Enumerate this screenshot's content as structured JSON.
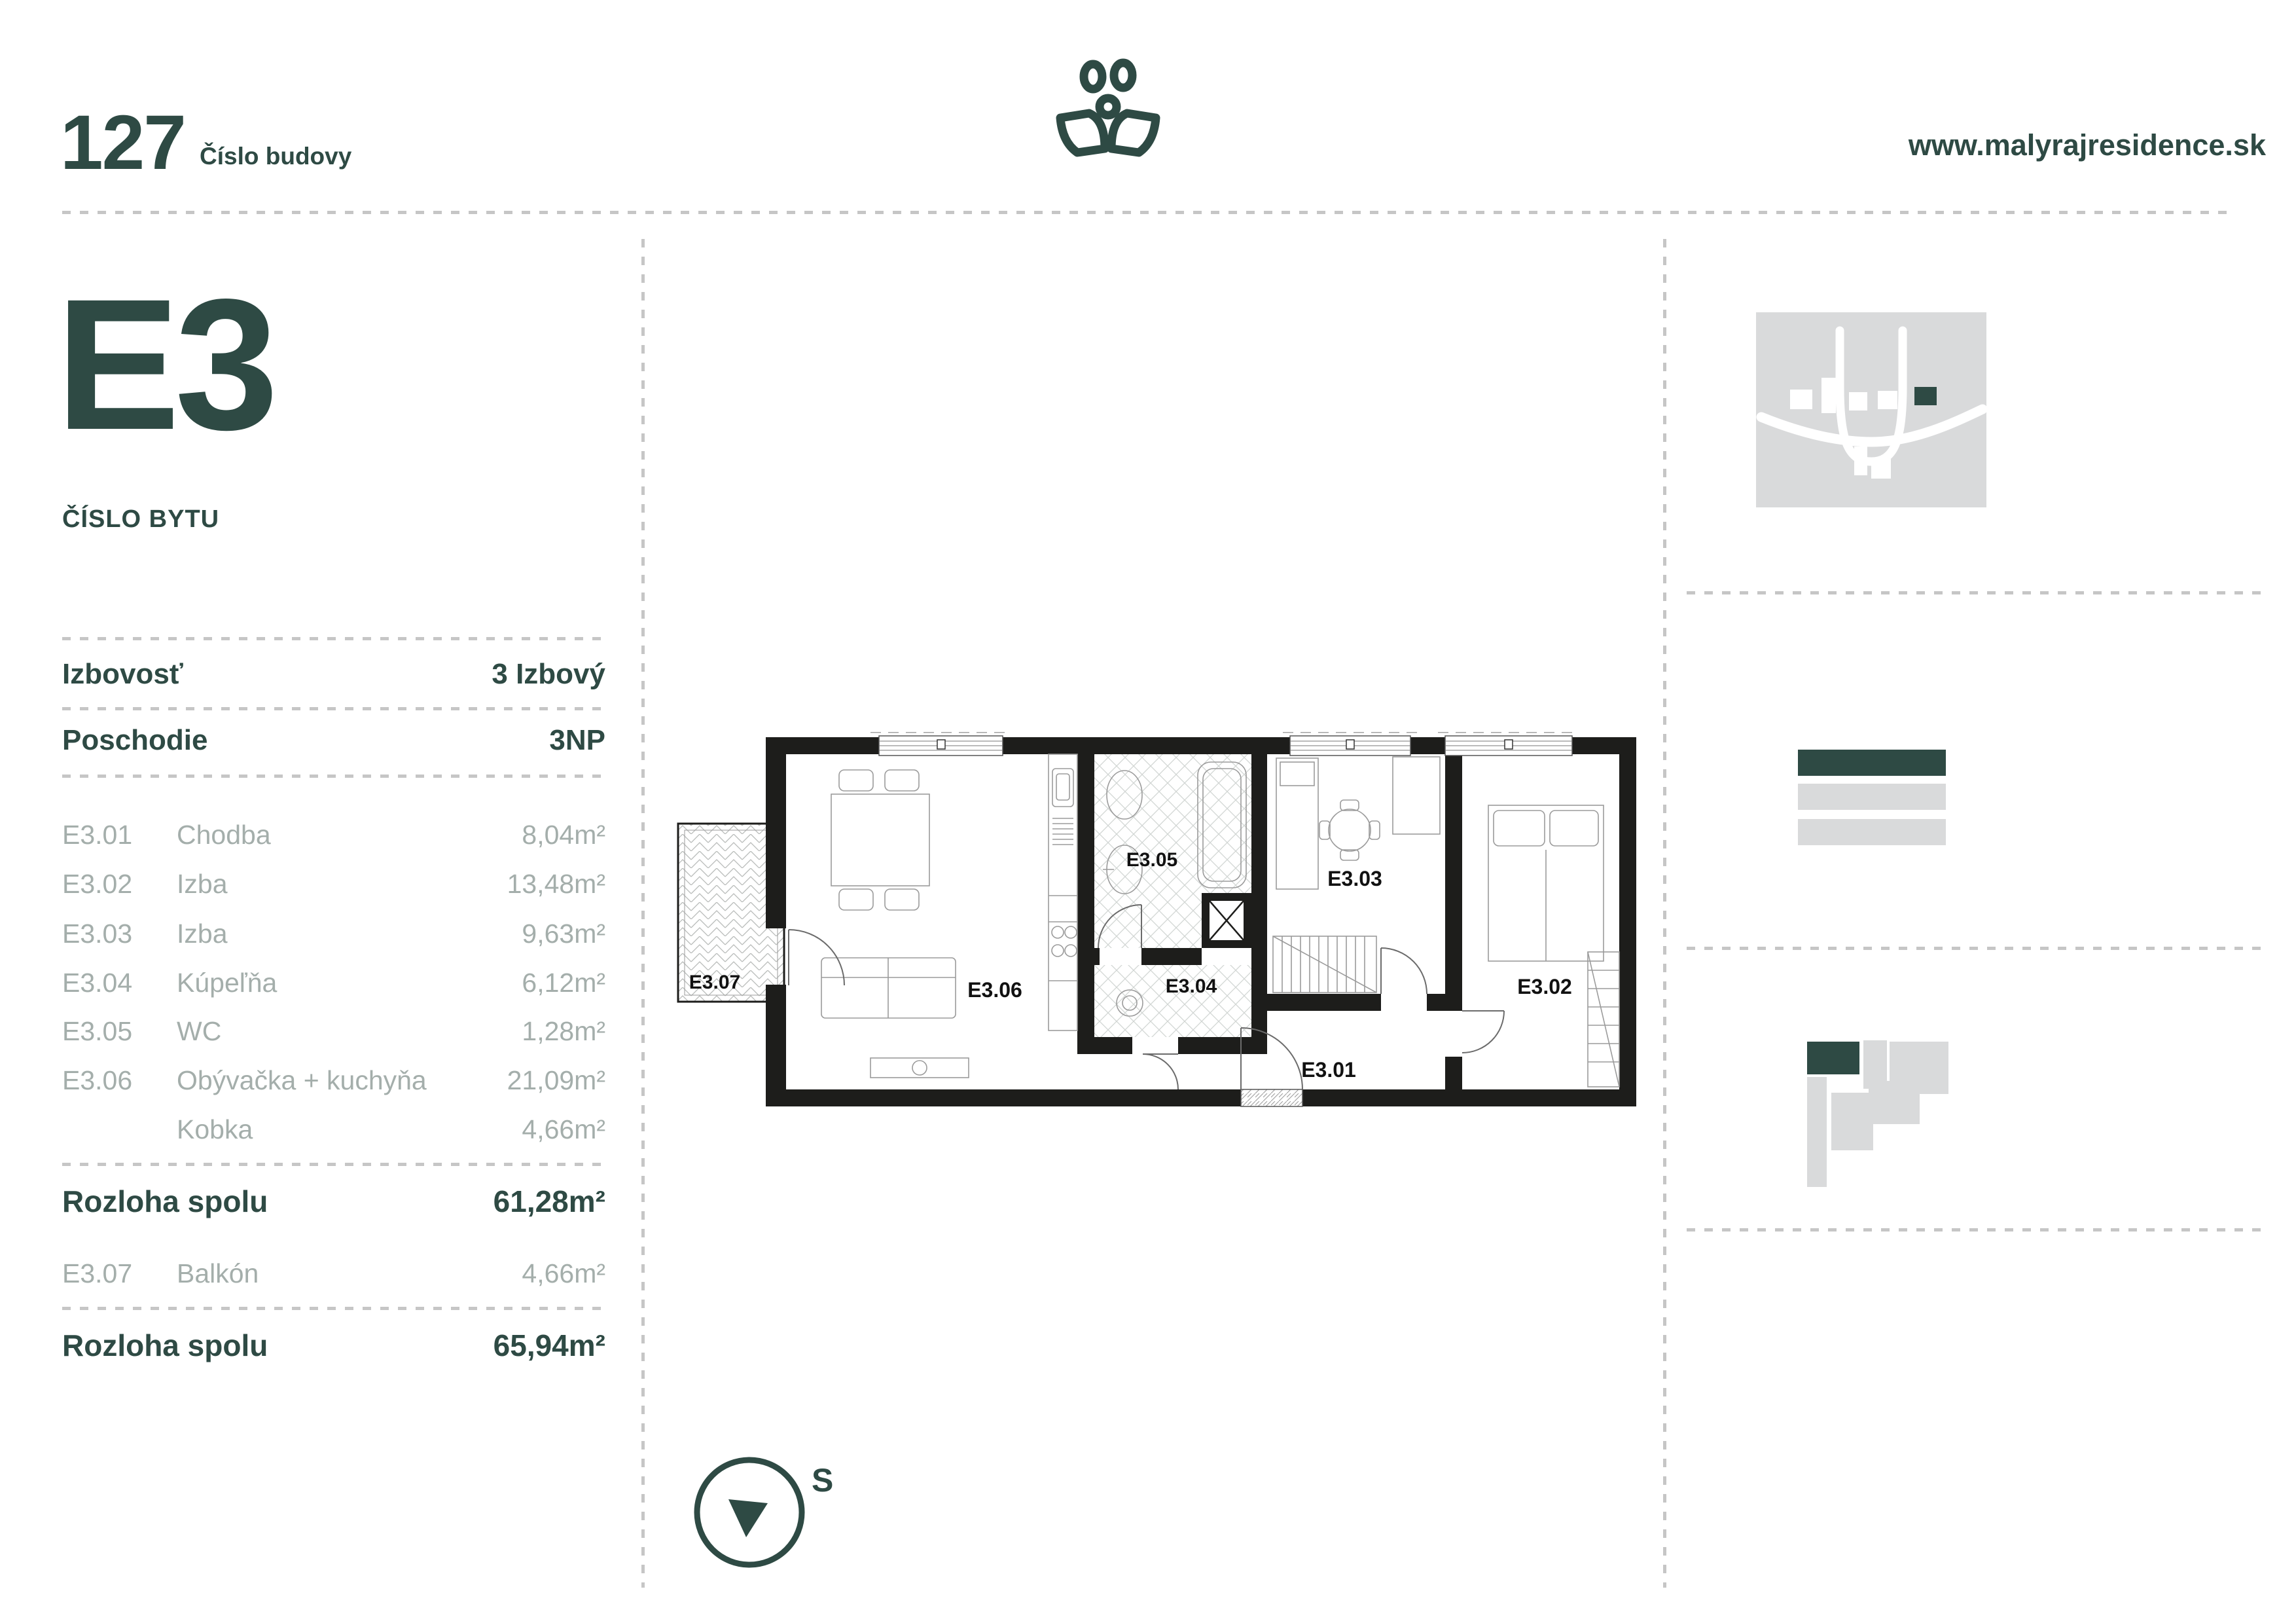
{
  "header": {
    "building_number": "127",
    "building_number_label": "Číslo budovy",
    "website": "www.malyrajresidence.sk",
    "logo": "plant-logo"
  },
  "unit": {
    "id": "E3",
    "id_label": "ČÍSLO BYTU"
  },
  "details": [
    {
      "label": "Izbovosť",
      "value": "3 Izbový"
    },
    {
      "label": "Poschodie",
      "value": "3NP"
    }
  ],
  "rooms": [
    {
      "code": "E3.01",
      "name": "Chodba",
      "area": "8,04m²"
    },
    {
      "code": "E3.02",
      "name": "Izba",
      "area": "13,48m²"
    },
    {
      "code": "E3.03",
      "name": "Izba",
      "area": "9,63m²"
    },
    {
      "code": "E3.04",
      "name": "Kúpeľňa",
      "area": "6,12m²"
    },
    {
      "code": "E3.05",
      "name": "WC",
      "area": "1,28m²"
    },
    {
      "code": "E3.06",
      "name": "Obývačka + kuchyňa",
      "area": "21,09m²"
    },
    {
      "code": "",
      "name": "Kobka",
      "area": "4,66m²"
    }
  ],
  "subtotal": {
    "label": "Rozloha spolu",
    "value": "61,28m²"
  },
  "balcony_row": {
    "code": "E3.07",
    "name": "Balkón",
    "area": "4,66m²"
  },
  "total": {
    "label": "Rozloha spolu",
    "value": "65,94m²"
  },
  "floorplan": {
    "labels": [
      "E3.01",
      "E3.02",
      "E3.03",
      "E3.04",
      "E3.05",
      "E3.06",
      "E3.07"
    ]
  },
  "compass": {
    "label": "S"
  },
  "colors": {
    "accent": "#2e4a44",
    "row_gray": "#a4aeab",
    "divider": "#c6c6c6",
    "map_gray": "#d9dadb",
    "wall_black": "#1d1d1b"
  }
}
